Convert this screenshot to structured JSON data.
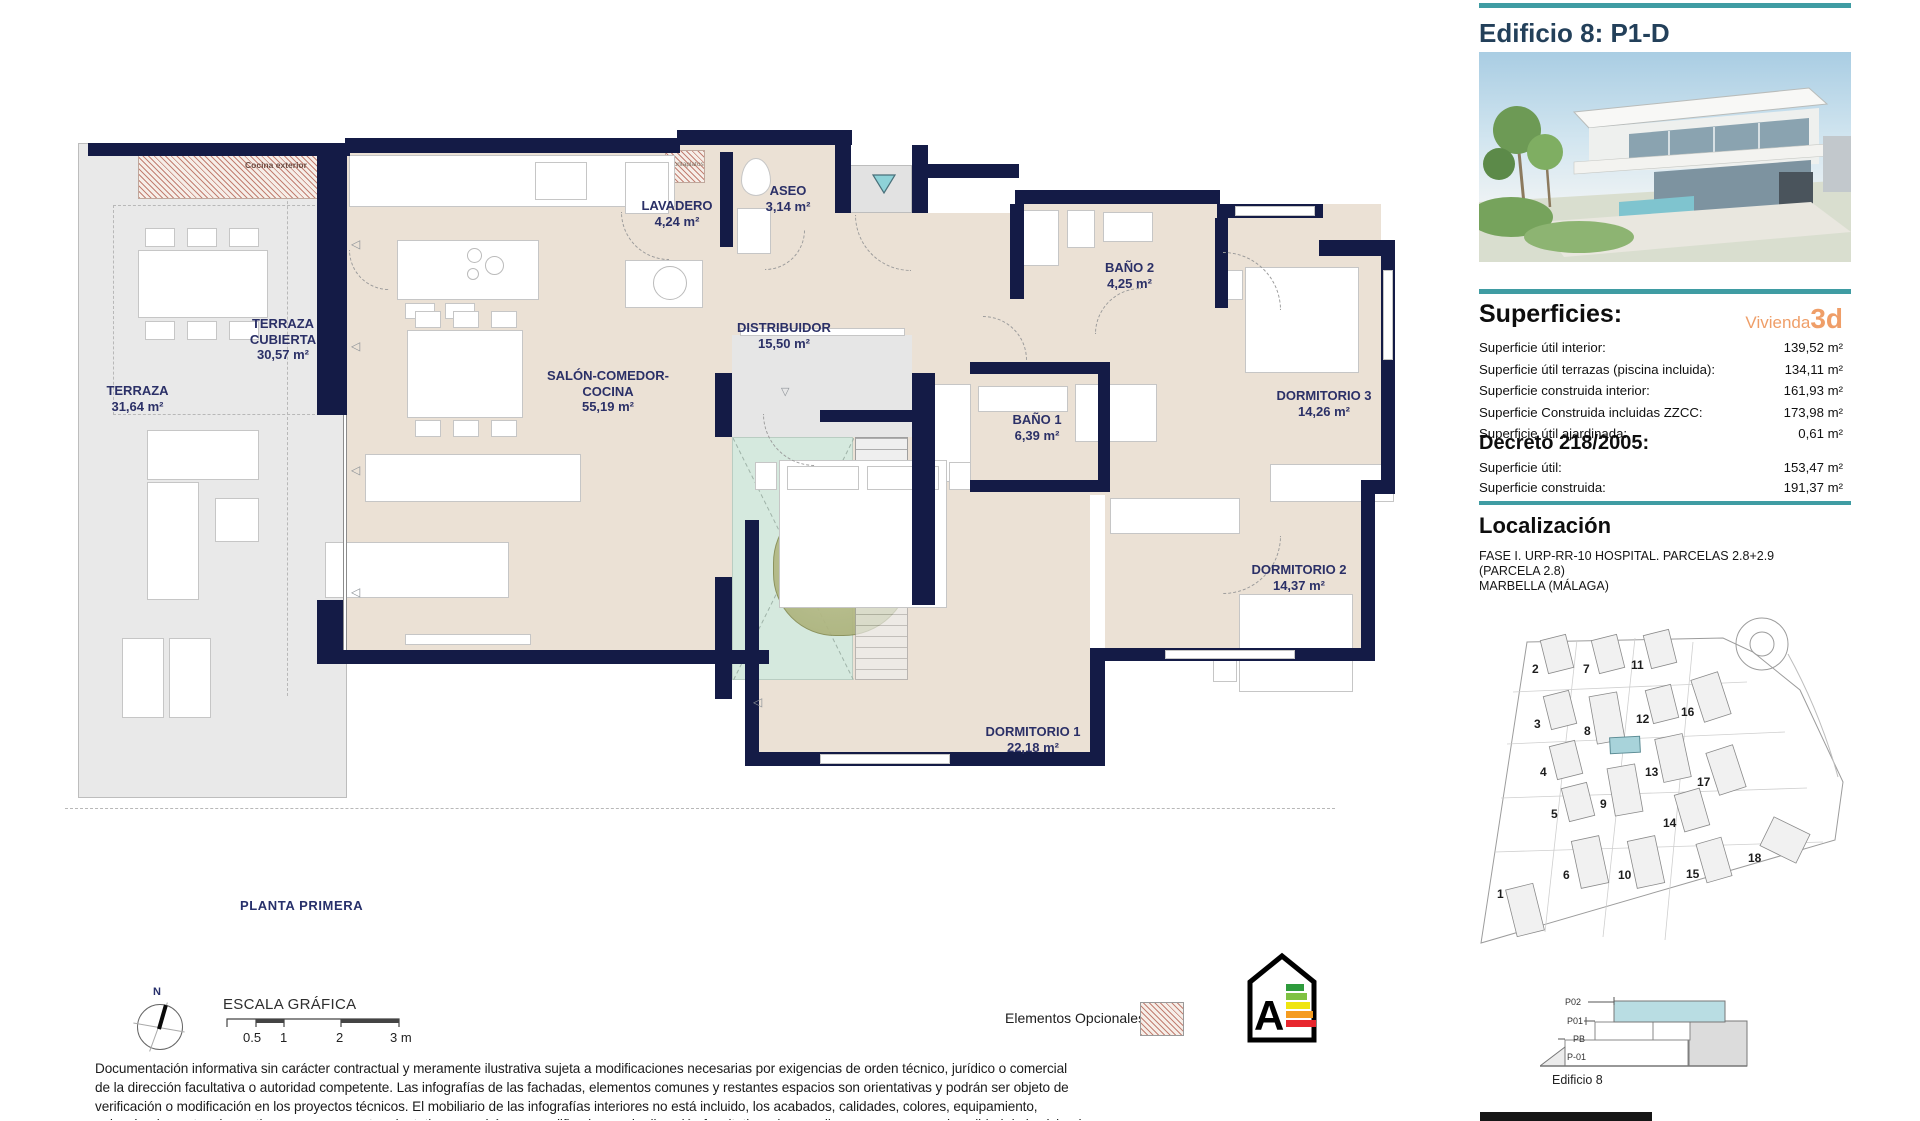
{
  "header": {
    "title": "Edificio 8: P1-D"
  },
  "superficies": {
    "heading": "Superficies:",
    "vivienda_label": "Vivienda",
    "vivienda_value": "3d",
    "rows": [
      {
        "label": "Superficie útil interior:",
        "value": "139,52 m²"
      },
      {
        "label": "Superficie útil terrazas (piscina incluida):",
        "value": "134,11 m²"
      },
      {
        "label": "Superficie construida interior:",
        "value": "161,93 m²"
      },
      {
        "label": "Superficie Construida incluidas ZZCC:",
        "value": "173,98 m²"
      },
      {
        "label": "Superficie útil ajardinada:",
        "value": "0,61 m²"
      }
    ]
  },
  "decreto": {
    "heading": "Decreto 218/2005:",
    "rows": [
      {
        "label": "Superficie útil:",
        "value": "153,47 m²"
      },
      {
        "label": "Superficie construida:",
        "value": "191,37 m²"
      }
    ]
  },
  "localizacion": {
    "heading": "Localización",
    "lines": [
      "FASE I. URP-RR-10 HOSPITAL. PARCELAS 2.8+2.9",
      "(PARCELA 2.8)",
      "MARBELLA (MÁLAGA)"
    ]
  },
  "site_map": {
    "buildings": [
      "2",
      "7",
      "11",
      "3",
      "8",
      "12",
      "16",
      "4",
      "13",
      "17",
      "5",
      "9",
      "14",
      "6",
      "10",
      "15",
      "18",
      "1"
    ]
  },
  "section": {
    "levels": [
      "P02",
      "P01",
      "PB",
      "P-01"
    ],
    "caption": "Edificio 8"
  },
  "plan": {
    "floor_label": "PLANTA PRIMERA",
    "compass_n": "N",
    "scale_title": "ESCALA GRÁFICA",
    "scale_ticks": [
      "0.5",
      "1",
      "2",
      "3 m"
    ],
    "legend_optional": "Elementos Opcionales",
    "energy_letter": "A",
    "annotations": {
      "cocina_exterior": "Cocina exterior",
      "montaplatos": "Montaplatos"
    },
    "rooms": [
      {
        "name": "TERRAZA",
        "area": "31,64 m²"
      },
      {
        "name": "TERRAZA CUBIERTA",
        "area": "30,57 m²"
      },
      {
        "name": "SALÓN-COMEDOR-COCINA",
        "area": "55,19 m²"
      },
      {
        "name": "LAVADERO",
        "area": "4,24 m²"
      },
      {
        "name": "ASEO",
        "area": "3,14 m²"
      },
      {
        "name": "DISTRIBUIDOR",
        "area": "15,50 m²"
      },
      {
        "name": "BAÑO 2",
        "area": "4,25 m²"
      },
      {
        "name": "BAÑO 1",
        "area": "6,39 m²"
      },
      {
        "name": "DORMITORIO 3",
        "area": "14,26 m²"
      },
      {
        "name": "DORMITORIO 2",
        "area": "14,37 m²"
      },
      {
        "name": "DORMITORIO 1",
        "area": "22,18 m²"
      }
    ]
  },
  "disclaimer": {
    "lines": [
      "Documentación informativa sin carácter contractual y meramente ilustrativa sujeta a modificaciones necesarias por exigencias de orden técnico, jurídico o comercial",
      "de la dirección facultativa o autoridad competente. Las infografías de las fachadas, elementos comunes y restantes espacios son orientativas y podrán ser objeto de",
      "verificación o modificación en los proyectos técnicos. El mobiliario de las infografías interiores no está incluido, los acabados, calidades, colores, equipamiento,",
      "y demás elementos decorativos son meramente orientativos y podrán ser modificados por la dirección facultativa, sin que ello suponga merma de calidad de la vivienda."
    ]
  }
}
